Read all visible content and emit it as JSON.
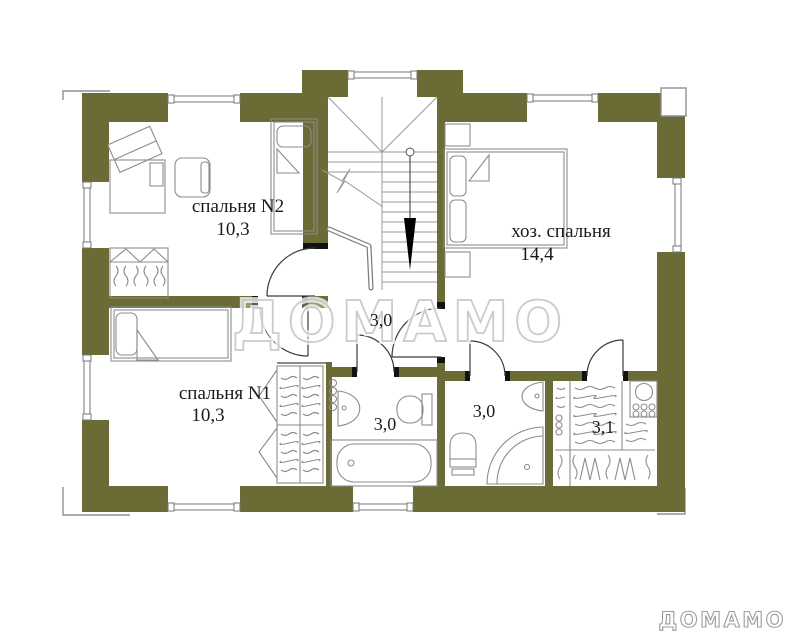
{
  "plan": {
    "type": "floor-plan",
    "watermark_center": "ДОМАМО",
    "watermark_corner": "ДОМАМО",
    "rooms": {
      "bedroom2": {
        "name": "спальня N2",
        "area": "10,3"
      },
      "master": {
        "name": "хоз. спальня",
        "area": "14,4"
      },
      "bedroom1": {
        "name": "спальня N1",
        "area": "10,3"
      },
      "hall": {
        "area": "3,0"
      },
      "bathroom1": {
        "area": "3,0"
      },
      "bathroom2": {
        "area": "3,0"
      },
      "closet": {
        "area": "3,1"
      }
    },
    "colors": {
      "wall": "#6b6b35",
      "cap": "#111111",
      "furniture_line": "#8c8c8c",
      "door_line": "#3a3a3a",
      "stair_line": "#999999",
      "watermark_center": "#c6c6c6",
      "watermark_corner": "#9c9c9c"
    }
  }
}
